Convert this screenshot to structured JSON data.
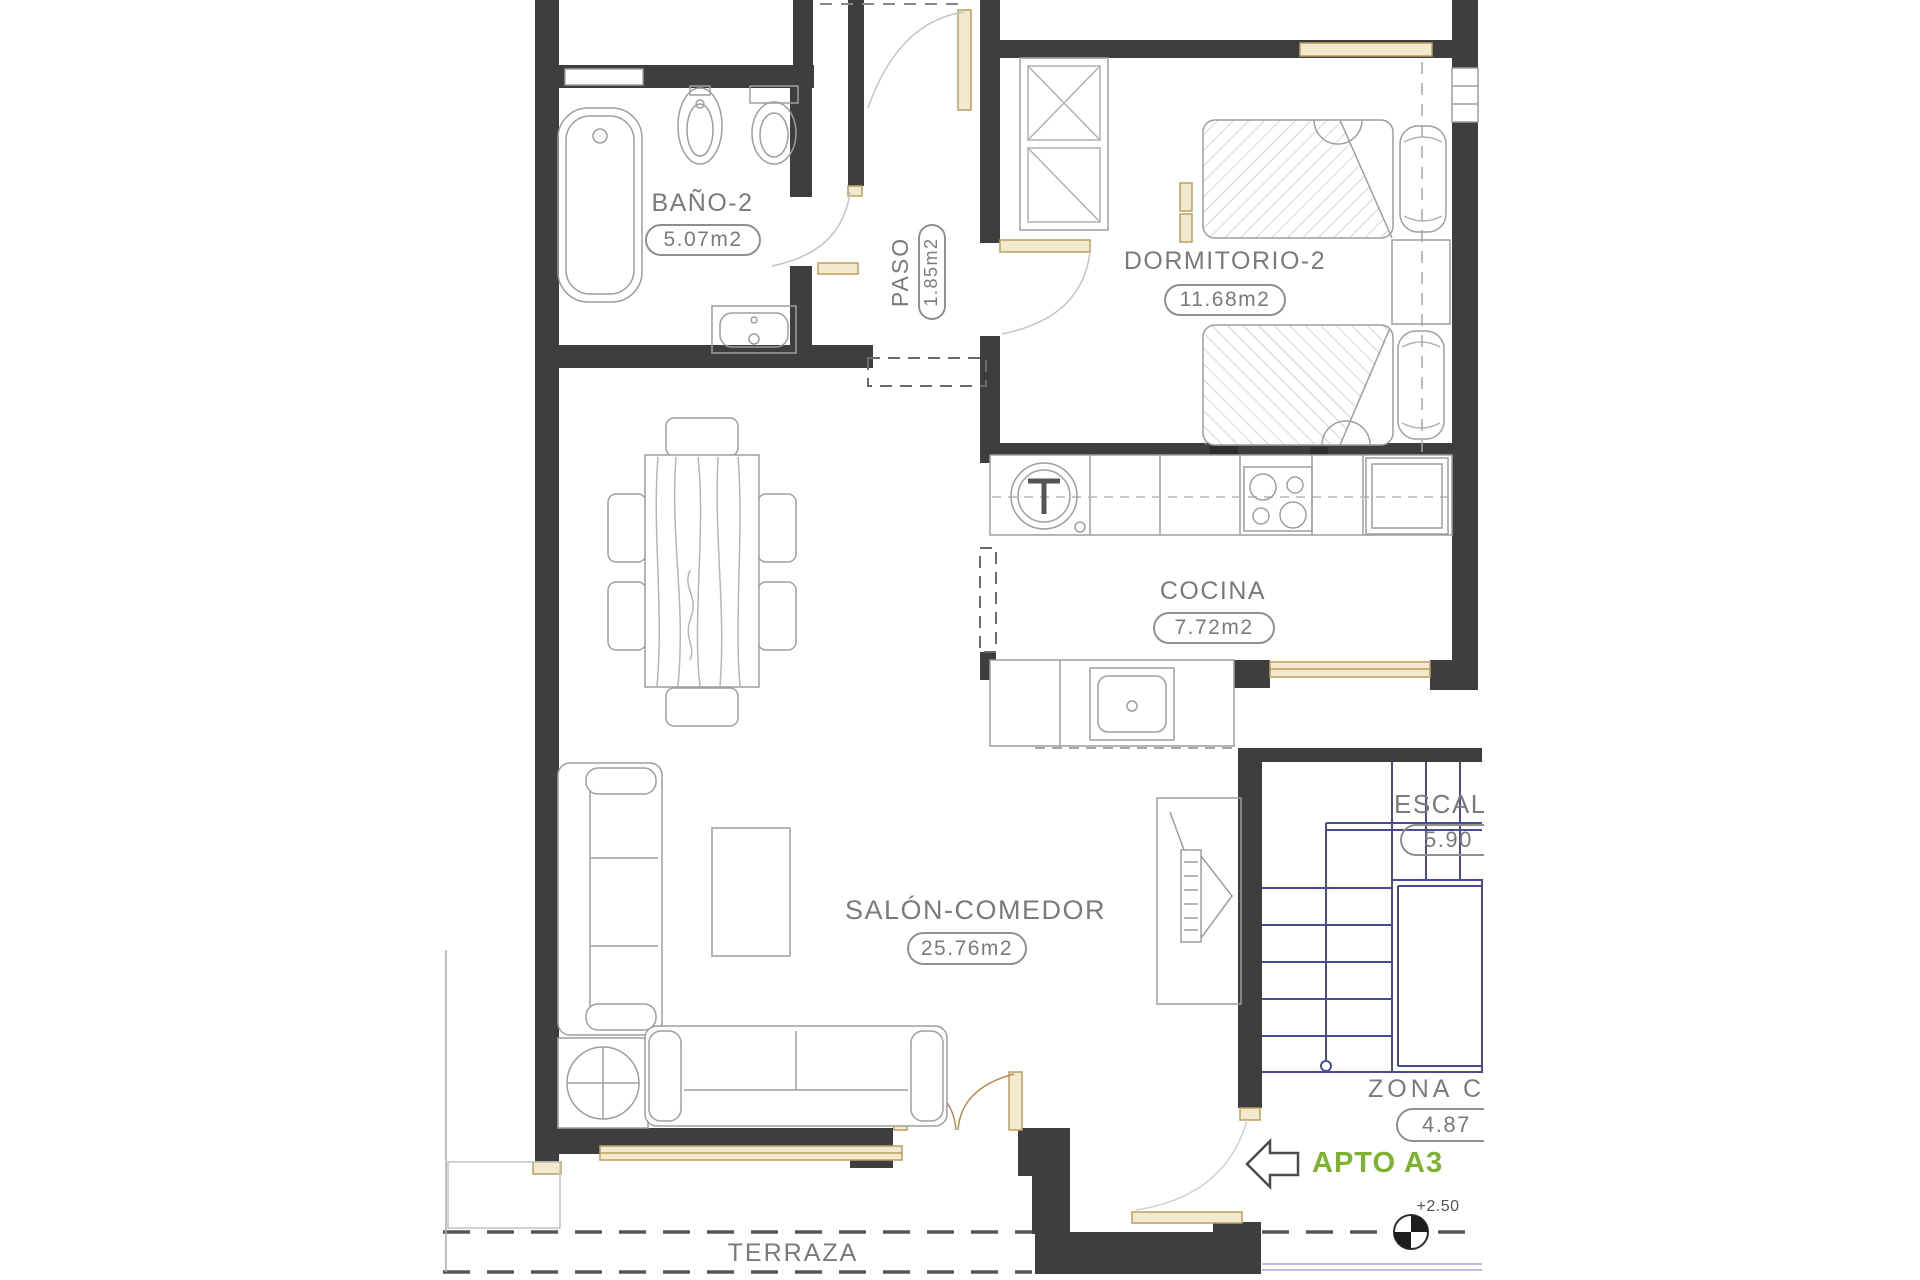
{
  "plan": {
    "rooms": [
      {
        "id": "bano2",
        "name": "BAÑO-2",
        "area": "5.07m2"
      },
      {
        "id": "paso",
        "name": "PASO",
        "area": "1.85m2"
      },
      {
        "id": "dormitorio2",
        "name": "DORMITORIO-2",
        "area": "11.68m2"
      },
      {
        "id": "cocina",
        "name": "COCINA",
        "area": "7.72m2"
      },
      {
        "id": "salon",
        "name": "SALÓN-COMEDOR",
        "area": "25.76m2"
      },
      {
        "id": "escalera",
        "name": "ESCAL",
        "area": "5.90"
      },
      {
        "id": "zona_comun",
        "name": "ZONA C",
        "area": "4.87"
      },
      {
        "id": "terraza",
        "name": "TERRAZA",
        "area": ""
      }
    ],
    "annotations": {
      "apartment": "APTO A3",
      "level": "+2.50"
    },
    "icons": {
      "entrance_arrow": "left-arrow",
      "level_marker": "benchmark-level-marker"
    },
    "colors": {
      "wall": "#3e3e3e",
      "accent_green": "#7db32f",
      "stair_blue": "#4b4b8f",
      "door_tan": "#f3e9cf",
      "label_gray": "#7a7a7a"
    }
  }
}
